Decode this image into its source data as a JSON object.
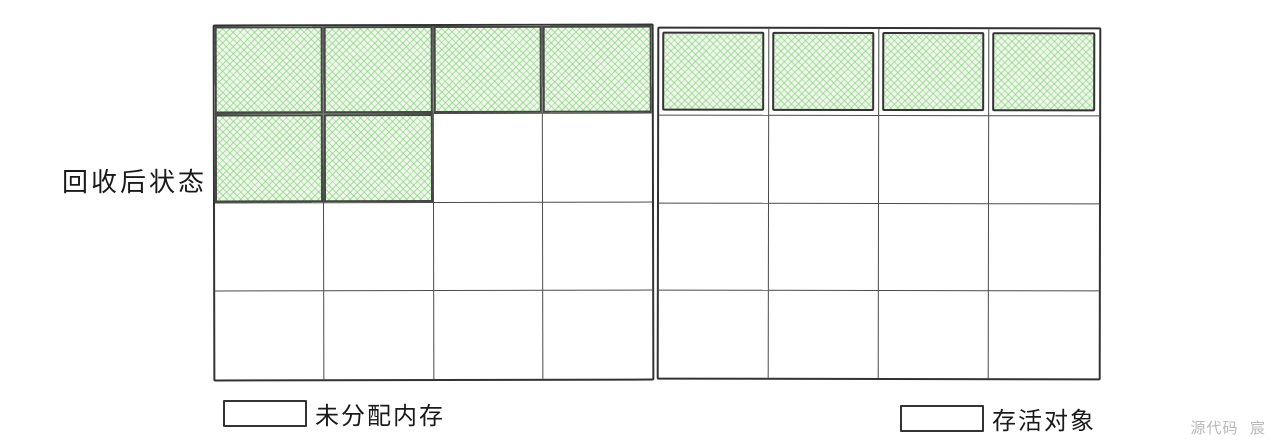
{
  "diagram": {
    "title": "回收后状态",
    "watermark": "源代码  宸"
  },
  "colors": {
    "stroke": "#333333",
    "grid_line": "#4a4a4a",
    "live_fill": "#edf8e8",
    "live_hatch": "#90d489",
    "watermark_gray": "#b9b9b9",
    "background": "#ffffff"
  },
  "grid": {
    "blocks": [
      {
        "name": "heap-block-left",
        "rows": 4,
        "cols": 4,
        "live_style": "flush",
        "cells": [
          [
            "live",
            "live",
            "live",
            "live"
          ],
          [
            "live",
            "live",
            "free",
            "free"
          ],
          [
            "free",
            "free",
            "free",
            "free"
          ],
          [
            "free",
            "free",
            "free",
            "free"
          ]
        ]
      },
      {
        "name": "heap-block-right",
        "rows": 4,
        "cols": 4,
        "live_style": "boxed",
        "cells": [
          [
            "live",
            "live",
            "live",
            "live"
          ],
          [
            "free",
            "free",
            "free",
            "free"
          ],
          [
            "free",
            "free",
            "free",
            "free"
          ],
          [
            "free",
            "free",
            "free",
            "free"
          ]
        ]
      }
    ]
  },
  "legend": {
    "items": [
      {
        "swatch": "free",
        "label": "未分配内存"
      },
      {
        "swatch": "live",
        "label": "存活对象"
      }
    ]
  }
}
